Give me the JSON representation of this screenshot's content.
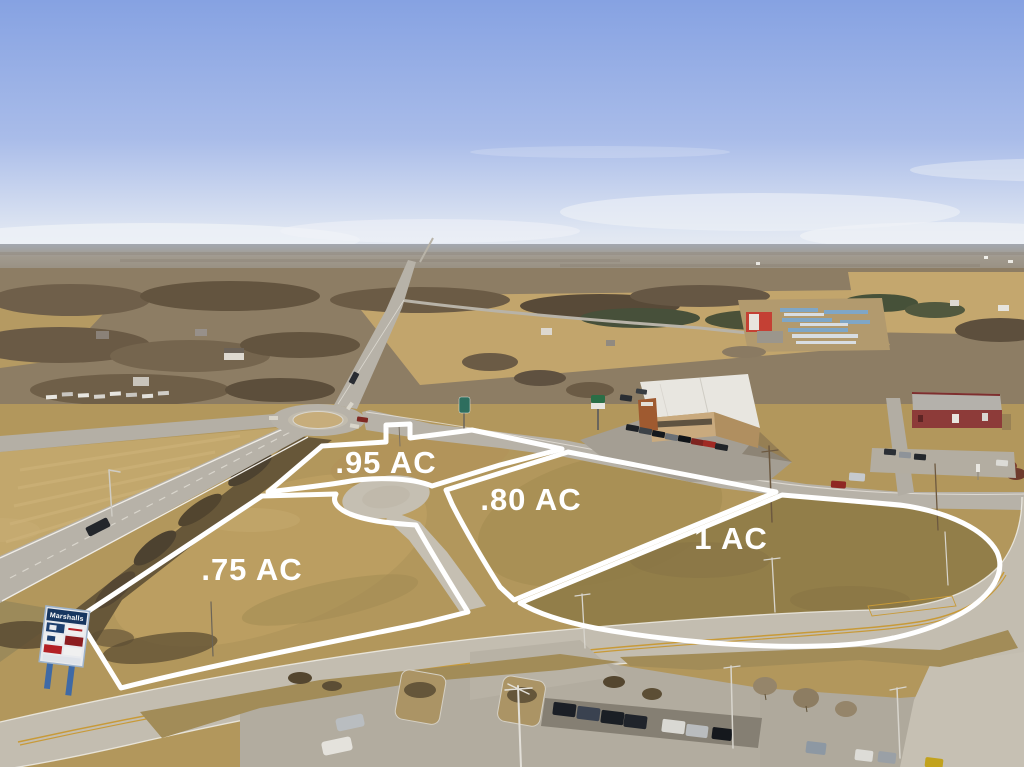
{
  "meta": {
    "kind": "aerial-drone-photo",
    "description": "Winter aerial photo of four white-outlined commercial lots for sale beside a roundabout intersection, with a cul-de-sac, boulevard, retail buildings, parking lots and a Marshalls pylon sign"
  },
  "overlay": {
    "outline_color": "#ffffff",
    "label_color": "#ffffff",
    "parcels": [
      {
        "id": "parcel-095",
        "label": ".95 AC"
      },
      {
        "id": "parcel-080",
        "label": ".80 AC"
      },
      {
        "id": "parcel-1",
        "label": "1 AC"
      },
      {
        "id": "parcel-075",
        "label": ".75 AC"
      }
    ]
  },
  "signage": {
    "pylon": {
      "title": "Marshalls"
    }
  },
  "palette": {
    "sky_top": "#86a2e2",
    "sky_horizon": "#e7ebf3",
    "grass_tan": "#b2975c",
    "road_gray": "#c3bdb0",
    "asphalt_dark": "#857f73",
    "sign_navy": "#17365f"
  }
}
